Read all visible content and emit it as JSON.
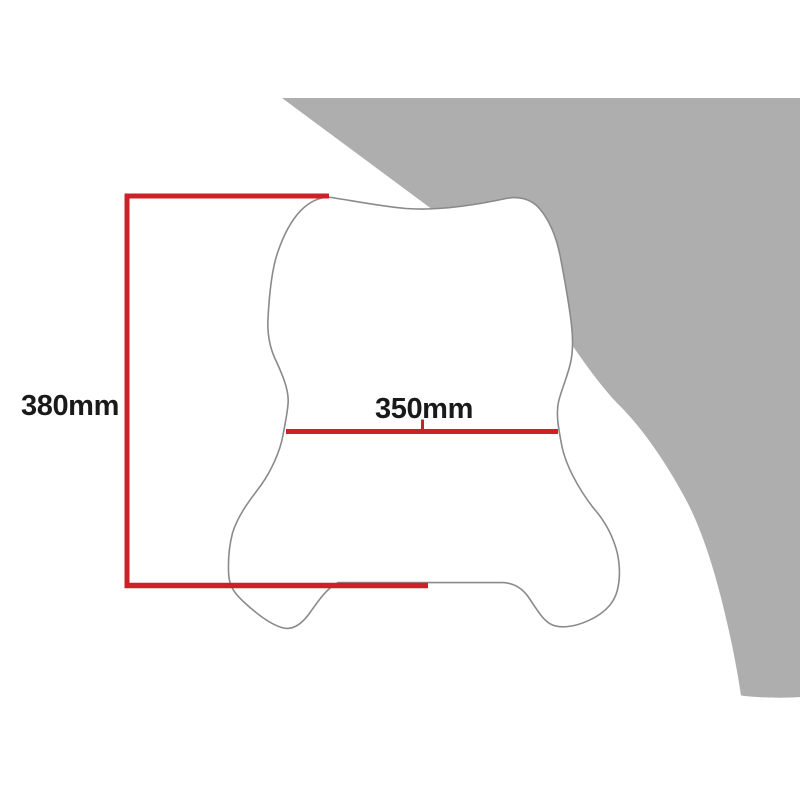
{
  "diagram": {
    "height_label": "380mm",
    "width_label": "350mm"
  },
  "colors": {
    "dimension_red": "#cc2127",
    "swoosh_gray": "#aeaeae",
    "outline_gray": "#8a8a8a",
    "label_text": "#1a1a1a"
  }
}
